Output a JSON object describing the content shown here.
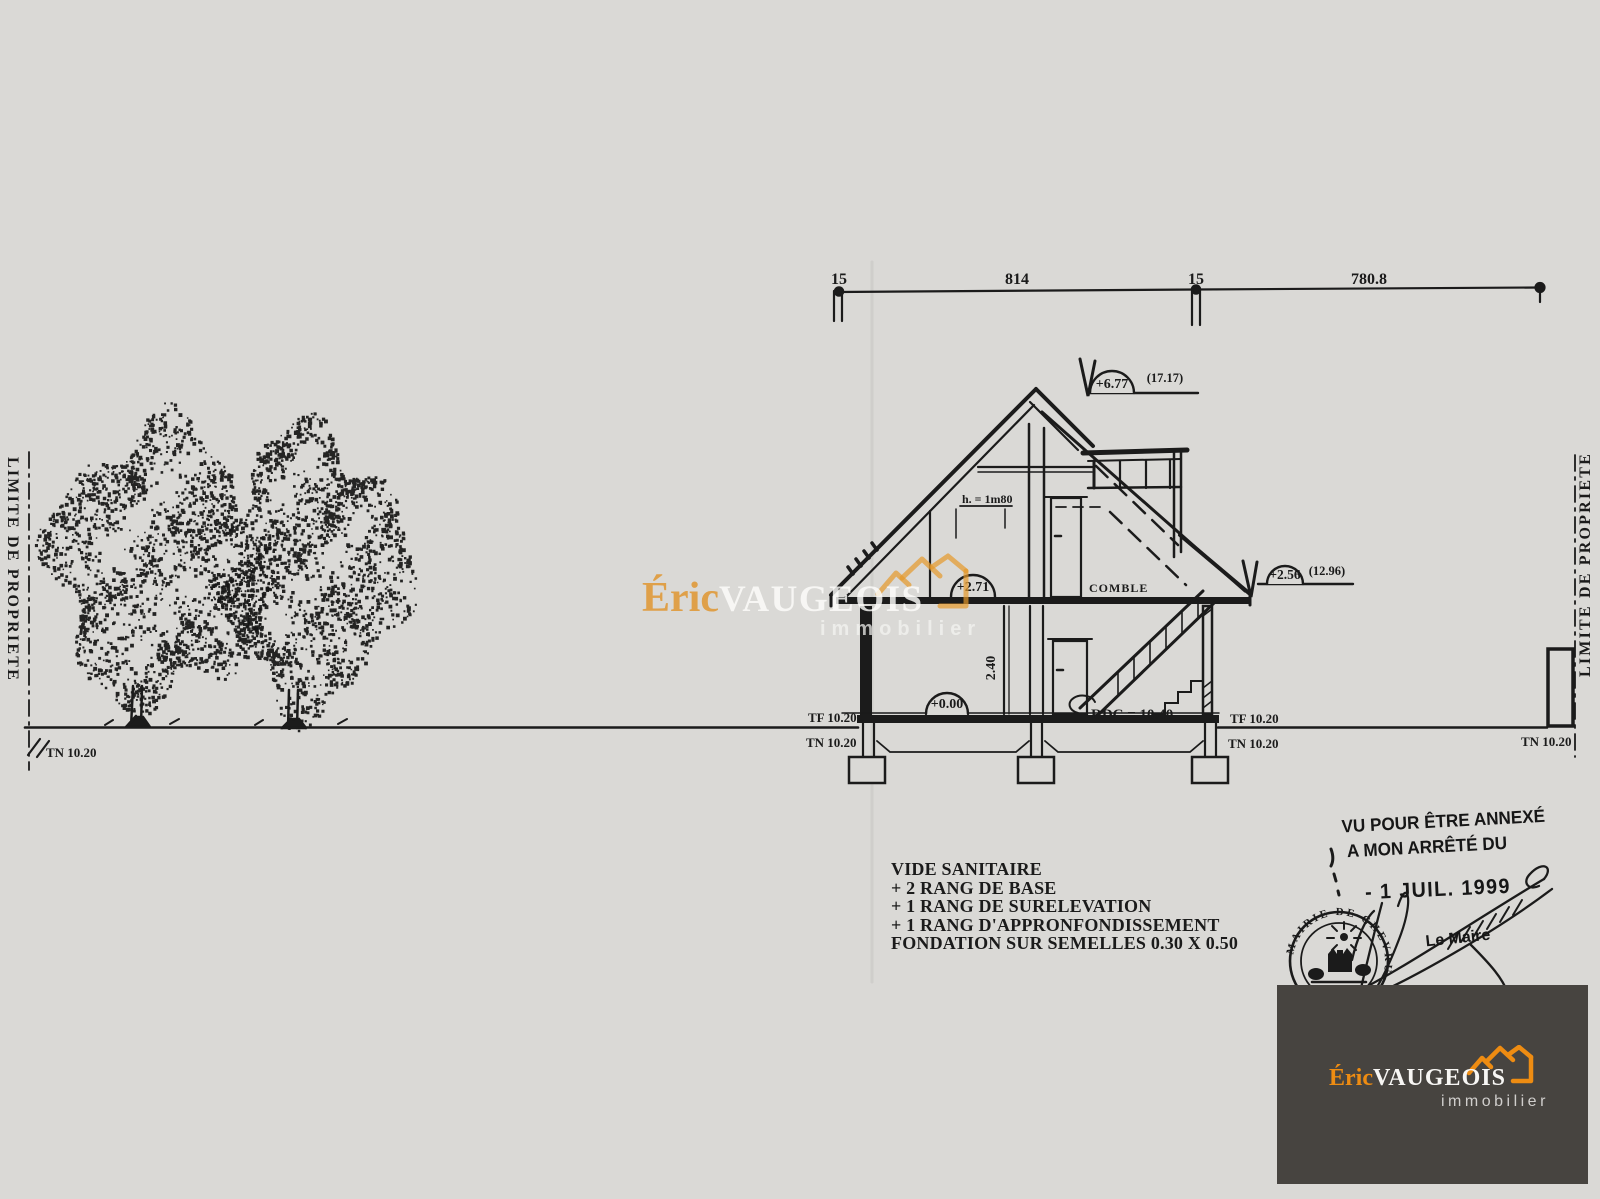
{
  "drawing": {
    "dimension_line": {
      "labels": [
        "15",
        "814",
        "15",
        "780.8"
      ]
    },
    "elevation_markers": {
      "ridge_value": "+6.77",
      "ridge_abs": "(17.17)",
      "eave_value": "+2.56",
      "eave_abs": "(12.96)",
      "attic_value": "+2.71",
      "ground_value": "+0.00"
    },
    "annotations": {
      "rdc": "RDC = 10.40",
      "attic_headroom": "h. = 1m80",
      "ceiling_height": "2.40",
      "comble": "COMBLE"
    },
    "levels": {
      "tn_far_left": "TN 10.20",
      "tf_left": "TF 10.20",
      "tn_left": "TN 10.20",
      "tf_right": "TF 10.20",
      "tn_right": "TN 10.20",
      "tn_far_right": "TN 10.20"
    },
    "property": {
      "left": "LIMITE DE PROPRIETE",
      "right": "LIMITE DE PROPRIETE"
    },
    "notes": [
      "VIDE SANITAIRE",
      "+ 2 RANG DE BASE",
      "+ 1 RANG DE SURELEVATION",
      "+ 1 RANG D'APPRONFONDISSEMENT",
      "FONDATION SUR SEMELLES 0.30 X 0.50"
    ]
  },
  "stamp": {
    "line1": "VU POUR ÊTRE ANNEXÉ",
    "line2": "A MON ARRÊTÉ DU",
    "date": "- 1 JUIL. 1999",
    "signer": "Le Maire",
    "seal": "MAIRIE DE CHEVRU"
  },
  "watermark": {
    "first": "Éric",
    "last": "VAUGEOIS",
    "tagline": "immobilier"
  },
  "logo": {
    "first": "Éric",
    "last": "VAUGEOIS",
    "tagline": "immobilier"
  },
  "colors": {
    "paper": "#dad9d6",
    "ink": "#1b1b1b",
    "orange": "#ee8c12",
    "logo_bg": "#474440"
  }
}
